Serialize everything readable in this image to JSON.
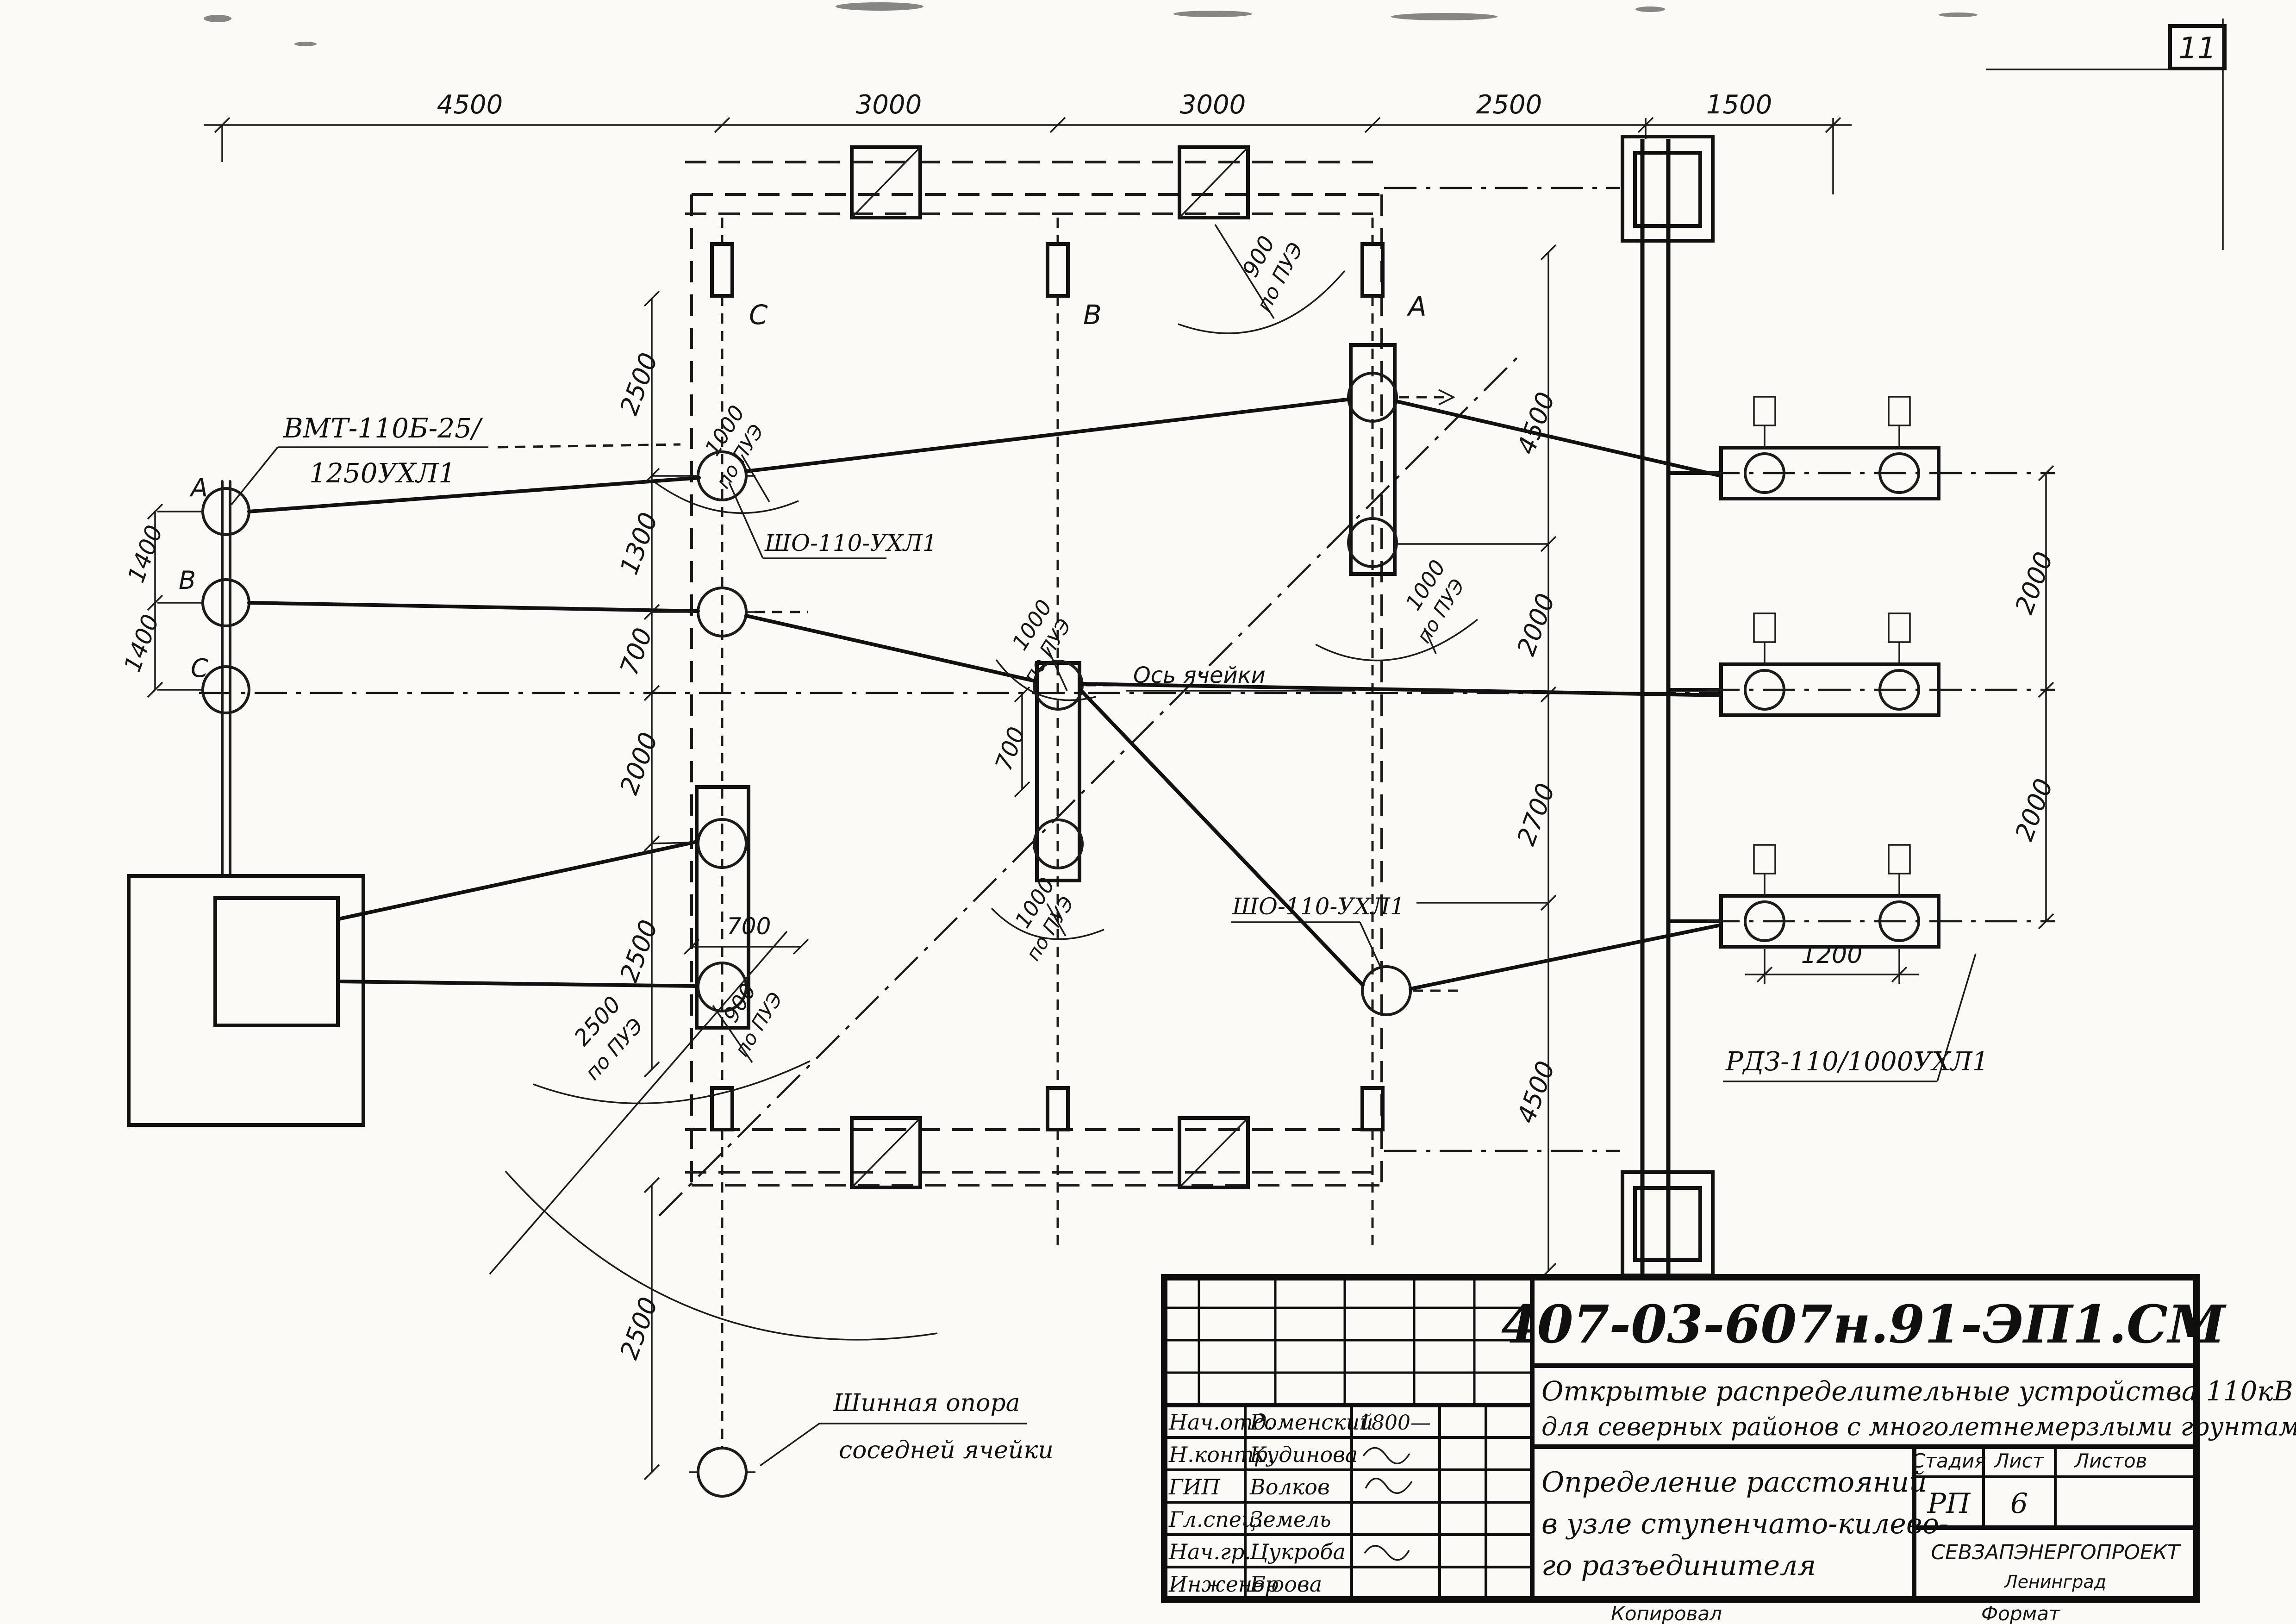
{
  "sheet": {
    "page_number": "11"
  },
  "dimensions": {
    "top": [
      "4500",
      "3000",
      "3000",
      "2500",
      "1500"
    ],
    "left_chain": [
      "2500",
      "1300",
      "700",
      "2000",
      "2500"
    ],
    "left_bottom": "2500",
    "phase_spacing": [
      "1400",
      "1400"
    ],
    "mid_chain": [
      "4500",
      "2000",
      "2700",
      "4500"
    ],
    "right_chain": [
      "2000",
      "2000"
    ],
    "pole_spacing": "1200",
    "small_700_a": "700",
    "small_700_b": "700"
  },
  "clearances": {
    "top_a": {
      "value": "900",
      "code": "по ПУЭ"
    },
    "sho_top": {
      "value": "1000",
      "code": "по ПУЭ"
    },
    "row_b": {
      "value": "1000",
      "code": "по ПУЭ"
    },
    "col_a": {
      "value": "1000",
      "code": "по ПУЭ"
    },
    "row_b_low": {
      "value": "1000",
      "code": "по ПУЭ"
    },
    "col_c_low": {
      "value": "900",
      "code": "по ПУЭ"
    },
    "swing": {
      "value": "2500",
      "code": "по ПУЭ"
    }
  },
  "equipment": {
    "breaker_model_top": "ВМТ-110Б-25/",
    "breaker_model_bottom": "1250УХЛ1",
    "bus_support_model": "ШО-110-УХЛ1",
    "bus_support_model_2": "ШО-110-УХЛ1",
    "disconnector_model": "РДЗ-110/1000УХЛ1",
    "cell_axis_label": "Ось ячейки",
    "neighbor_support_line1": "Шинная опора",
    "neighbor_support_line2": "соседней ячейки",
    "column_marks": [
      "С",
      "В",
      "А"
    ],
    "phase_marks": [
      "А",
      "В",
      "С"
    ]
  },
  "title_block": {
    "doc_number": "407-03-607н.91-ЭП1.СМ",
    "title_line1": "Открытые распределительные устройства 110кВ",
    "title_line2": "для северных районов с многолетнемерзлыми грунтами",
    "name_line1": "Определение расстояний",
    "name_line2": "в узле ступенчато-килево-",
    "name_line3": "го разъединителя",
    "col_stage": "Стадия",
    "col_sheet": "Лист",
    "col_sheets": "Листов",
    "stage": "РП",
    "sheet_no": "6",
    "org_line1": "СЕВЗАПЭНЕРГОПРОЕКТ",
    "org_line2": "Ленинград",
    "footer_copy": "Копировал",
    "footer_format": "Формат",
    "personnel": [
      {
        "role": "Нач.отд.",
        "name": "Роменский",
        "note": "1800—"
      },
      {
        "role": "Н.контр.",
        "name": "Кудинова",
        "note": ""
      },
      {
        "role": "ГИП",
        "name": "Волков",
        "note": ""
      },
      {
        "role": "Гл.спец.",
        "name": "Земель",
        "note": ""
      },
      {
        "role": "Нач.гр.",
        "name": "Цукроба",
        "note": ""
      },
      {
        "role": "Инженер",
        "name": "Бюова",
        "note": ""
      }
    ]
  }
}
